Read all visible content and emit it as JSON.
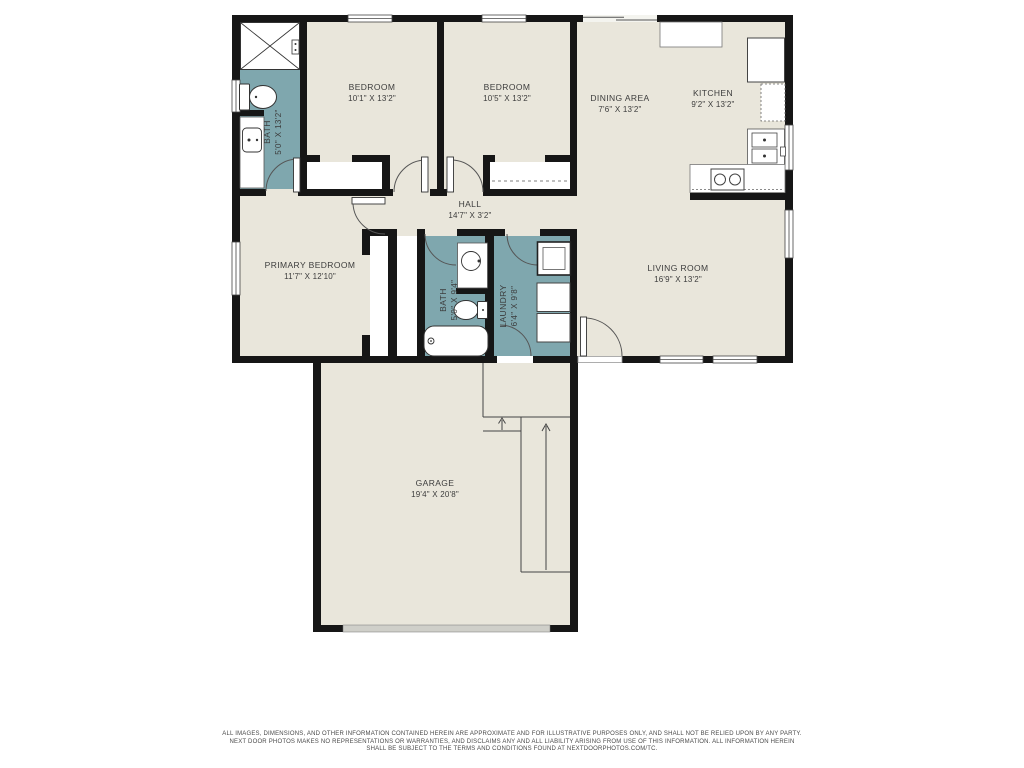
{
  "colors": {
    "floor": "#e9e6db",
    "wet_room": "#7fa7ae",
    "wall": "#161616",
    "text": "#3c3c3c",
    "garage_door": "#cfcfc9"
  },
  "rooms": {
    "bath1": {
      "name": "BATH",
      "dims": "5'0\" X 13'2\""
    },
    "bedroom1": {
      "name": "BEDROOM",
      "dims": "10'1\" X 13'2\""
    },
    "bedroom2": {
      "name": "BEDROOM",
      "dims": "10'5\" X 13'2\""
    },
    "dining": {
      "name": "DINING AREA",
      "dims": "7'6\" X 13'2\""
    },
    "kitchen": {
      "name": "KITCHEN",
      "dims": "9'2\" X 13'2\""
    },
    "hall": {
      "name": "HALL",
      "dims": "14'7\" X 3'2\""
    },
    "primary": {
      "name": "PRIMARY BEDROOM",
      "dims": "11'7\" X 12'10\""
    },
    "bath2": {
      "name": "BATH",
      "dims": "5'0\" X 9'4\""
    },
    "laundry": {
      "name": "LAUNDRY",
      "dims": "6'4\" X 9'8\""
    },
    "living": {
      "name": "LIVING ROOM",
      "dims": "16'9\" X 13'2\""
    },
    "garage": {
      "name": "GARAGE",
      "dims": "19'4\" X 20'8\""
    }
  },
  "footer": {
    "line1": "ALL IMAGES, DIMENSIONS, AND OTHER INFORMATION CONTAINED HEREIN ARE APPROXIMATE AND FOR ILLUSTRATIVE PURPOSES ONLY, AND SHALL NOT BE RELIED UPON BY ANY PARTY.",
    "line2": "NEXT DOOR PHOTOS MAKES NO REPRESENTATIONS OR WARRANTIES, AND DISCLAIMS ANY AND ALL LIABILITY ARISING FROM USE OF THIS INFORMATION. ALL INFORMATION HEREIN",
    "line3": "SHALL BE SUBJECT TO THE TERMS AND CONDITIONS FOUND AT NEXTDOORPHOTOS.COM/TC."
  }
}
